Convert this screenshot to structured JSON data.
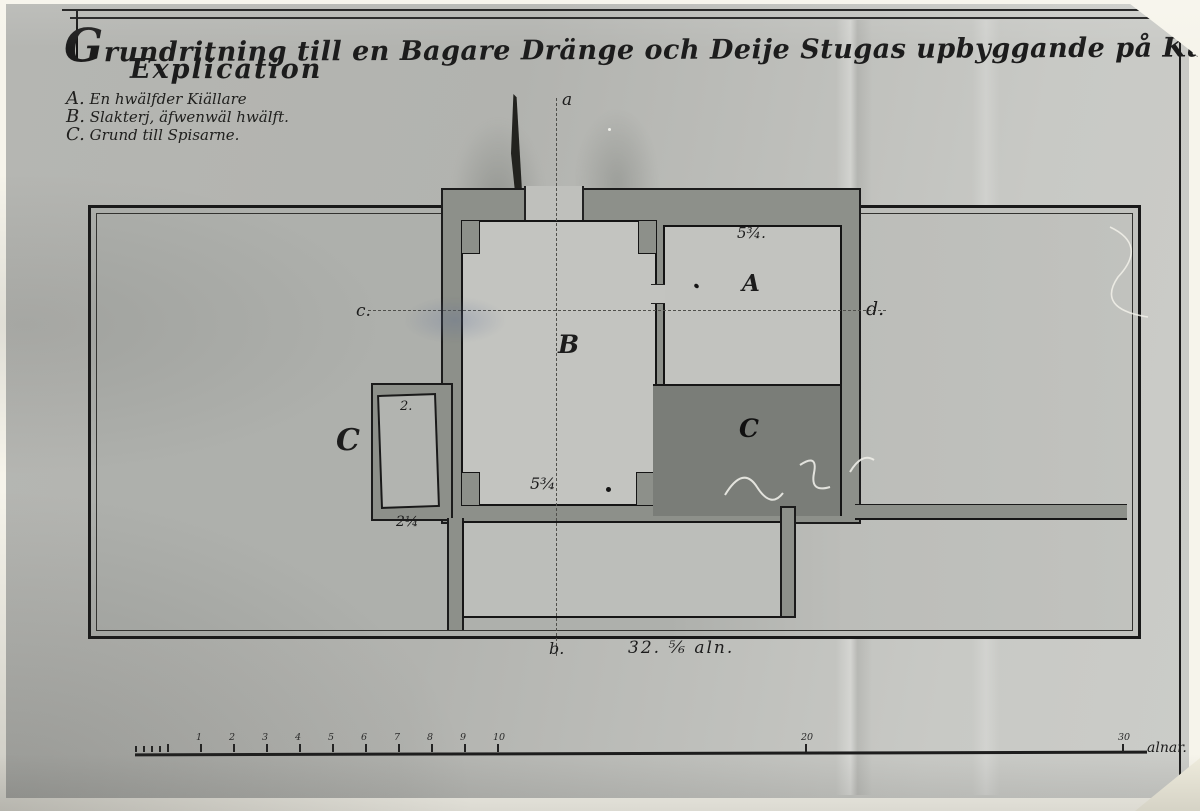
{
  "title": "Grundritning till en Bagare Dränge och Deije Stugas upbyggande på Kungsgården Johannisberg.",
  "explication": {
    "heading": "Explication",
    "items": [
      "A. En hwälfder Kiällare",
      "B. Slakterj, äfwenwäl hwälft.",
      "C. Grund till Spisarne."
    ]
  },
  "plan": {
    "room_a_label": "A",
    "room_b_label": "B",
    "dark_area_label": "C",
    "hearth_label": "C",
    "hearth_inner_label": "2.",
    "room_a_dim": "5¾.",
    "room_b_dim": "5¾",
    "hearth_dim": "2¼",
    "section_top": "a",
    "section_bottom": "b.",
    "section_left": "c.",
    "section_right": "d.",
    "bottom_dimension": "32. ⅚ aln."
  },
  "scale_bar": {
    "major_ticks": [
      "1",
      "2",
      "3",
      "4",
      "5",
      "6",
      "7",
      "8",
      "9",
      "10"
    ],
    "tick_20": "20",
    "tick_30": "30",
    "unit_label": "alnar."
  },
  "colors": {
    "paper": "#bdbeba",
    "wall": "#8d908a",
    "dark_fill": "#7a7d78",
    "ink": "#1a1a1a"
  }
}
